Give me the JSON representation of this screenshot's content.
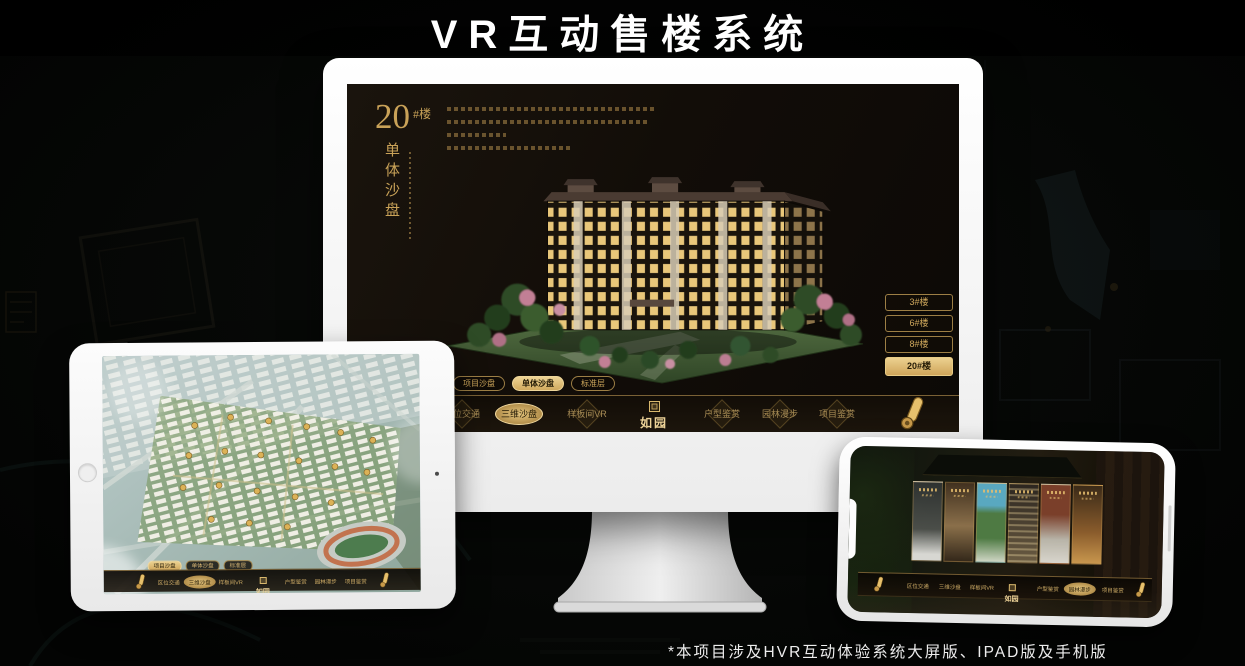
{
  "page": {
    "title": "VR互动售楼系统",
    "footnote": "*本项目涉及HVR互动体验系统大屏版、IPAD版及手机版"
  },
  "colors": {
    "gold": "#c9a258",
    "gold_bright": "#e8cc86",
    "active_fill": "#d9b469",
    "screen_bg": "#15100b",
    "monitor_body": "#ffffff"
  },
  "brand": {
    "logo": "如园",
    "seal_icon": "seal-icon"
  },
  "nav": {
    "items": [
      {
        "label": "区位交通"
      },
      {
        "label": "三维沙盘"
      },
      {
        "label": "样板间VR"
      },
      {
        "label": "户型鉴赏"
      },
      {
        "label": "园林漫步"
      },
      {
        "label": "项目鉴赏"
      }
    ],
    "scroll_icon": "scroll-icon"
  },
  "view_tabs": [
    {
      "label": "项目沙盘"
    },
    {
      "label": "单体沙盘"
    },
    {
      "label": "标准层"
    }
  ],
  "monitor": {
    "headline": {
      "number": "20",
      "suffix": "#楼",
      "vertical": "单体沙盘"
    },
    "active_view_tab": "单体沙盘",
    "active_nav": "三维沙盘",
    "floor_buttons": [
      {
        "label": "3#楼",
        "active": false
      },
      {
        "label": "6#楼",
        "active": false
      },
      {
        "label": "8#楼",
        "active": false
      },
      {
        "label": "20#楼",
        "active": true
      }
    ]
  },
  "tablet": {
    "active_view_tab": "项目沙盘",
    "active_nav": "三维沙盘"
  },
  "phone": {
    "active_nav": "园林漫步",
    "gallery_panel_count": 6
  }
}
